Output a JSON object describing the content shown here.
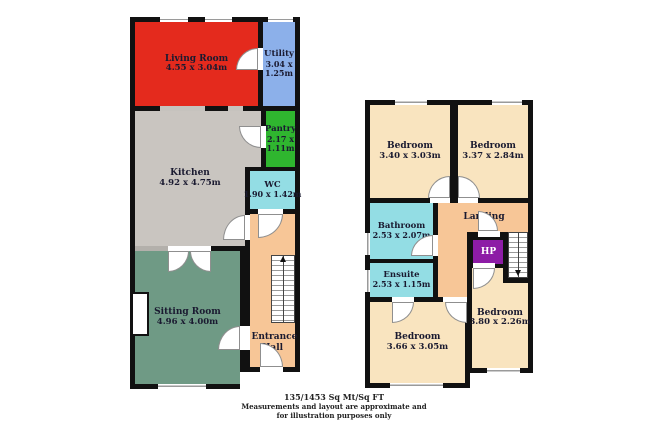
{
  "ground_floor": {
    "rooms": {
      "living": {
        "name": "Living Room",
        "dims": "4.55 x 3.04m"
      },
      "utility": {
        "name": "Utility",
        "dims": "3.04 x 1.25m"
      },
      "kitchen": {
        "name": "Kitchen",
        "dims": "4.92 x 4.75m"
      },
      "pantry": {
        "name": "Pantry",
        "dims": "2.17 x 1.11m"
      },
      "wc": {
        "name": "WC",
        "dims": "1.90 x 1.42m"
      },
      "sitting": {
        "name": "Sitting Room",
        "dims": "4.96 x 4.00m"
      },
      "hall": {
        "name": "Entrance Hall"
      }
    }
  },
  "first_floor": {
    "rooms": {
      "bed1": {
        "name": "Bedroom",
        "dims": "3.40 x 3.03m"
      },
      "bed2": {
        "name": "Bedroom",
        "dims": "3.37 x 2.84m"
      },
      "bathroom": {
        "name": "Bathroom",
        "dims": "2.53 x 2.07m"
      },
      "ensuite": {
        "name": "Ensuite",
        "dims": "2.53 x 1.15m"
      },
      "landing": {
        "name": "Landing"
      },
      "hp": {
        "name": "HP"
      },
      "bed3": {
        "name": "Bedroom",
        "dims": "3.66 x 3.05m"
      },
      "bed4": {
        "name": "Bedroom",
        "dims": "3.80 x 2.26m"
      }
    }
  },
  "footer": {
    "area": "135/1453 Sq Mt/Sq FT",
    "disclaimer1": "Measurements and layout are approximate and",
    "disclaimer2": "for illustration purposes only"
  },
  "colors": {
    "living_red": "#e42a1d",
    "utility_blue": "#8cb0ea",
    "pantry_green": "#2fb62f",
    "kitchen_gray": "#c9c5c0",
    "wet_room_cyan": "#93dde4",
    "sitting_green": "#6f9a85",
    "circulation_peach": "#f7c697",
    "bedroom_tan": "#f9e4bf",
    "hp_purple": "#8d1ca6",
    "wall_black": "#111111"
  }
}
